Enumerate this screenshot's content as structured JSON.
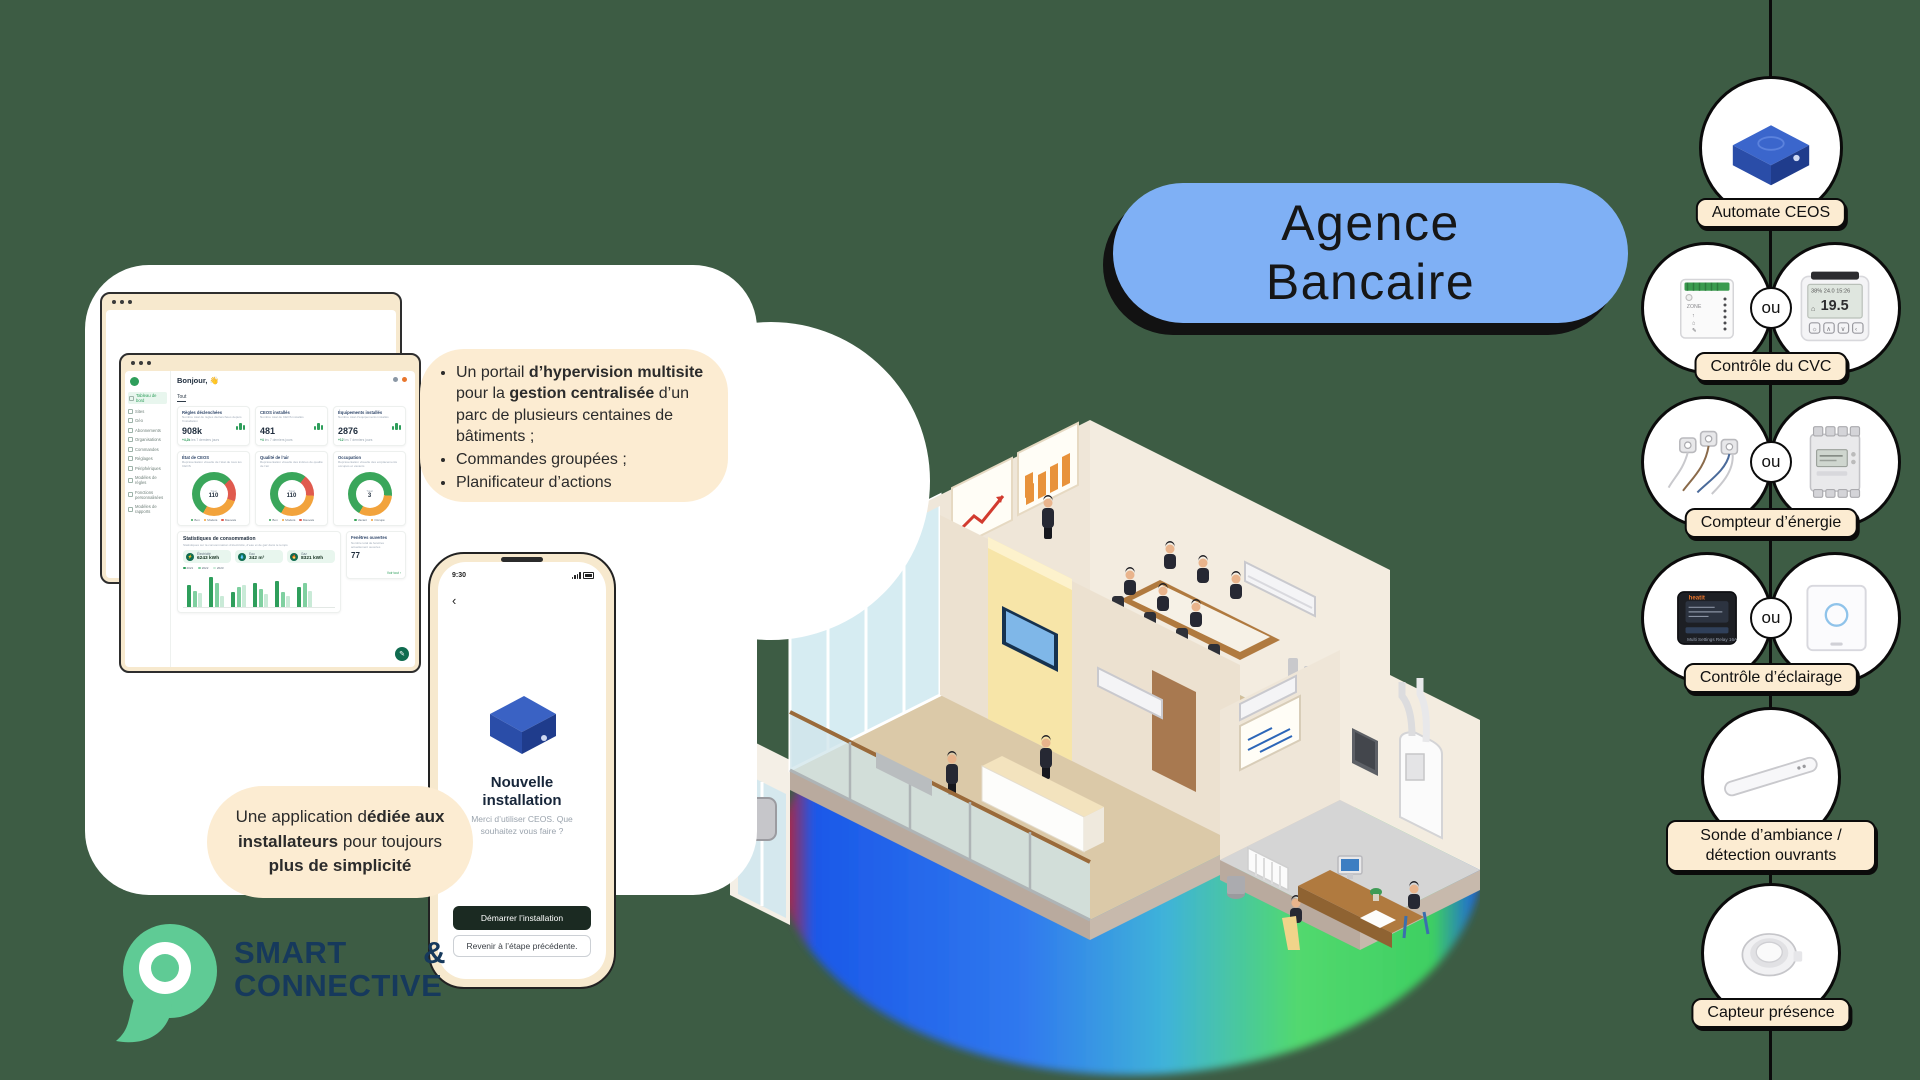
{
  "page": {
    "background": "#3d5c44"
  },
  "title_pill": {
    "line1": "Agence",
    "line2": "Bancaire",
    "bg": "#7fb0f5"
  },
  "callouts": {
    "portal": {
      "b1s1": "Un portail ",
      "b1s2": "d’hypervision multisite",
      "b1s3": " pour la ",
      "b1s4": "gestion centralisée",
      "b1s5": " d’un parc de plusieurs centaines de bâtiments ;",
      "b2": "Commandes groupées ;",
      "b3": "Planificateur d’actions"
    },
    "app": {
      "s1": "Une application d",
      "s2": "édiée aux installateurs",
      "s3": " pour toujours ",
      "s4": "plus de simplicité"
    }
  },
  "logo": {
    "word1": "SMART",
    "amp": "&",
    "word2": "CONNECTIVE"
  },
  "dashboard": {
    "greeting": "Bonjour,",
    "greeting_emoji": "👋",
    "tab": "Tout",
    "sidebar": [
      "Tableau de bord",
      "Sites",
      "Géo",
      "Abonnements",
      "Organisations",
      "Commandes",
      "Réglages",
      "Périphériques",
      "Modèles de règles",
      "Fonctions personnalisées",
      "Modèles de rapports"
    ],
    "stats": [
      {
        "title": "Règles déclenchées",
        "subtitle": "Nombre total de règles déclenchées depuis l’installation",
        "value": "908k",
        "delta_val": "+4,2k",
        "delta_txt": "les 7 derniers jours"
      },
      {
        "title": "CEOS installés",
        "subtitle": "Nombre total de CEOS installés",
        "value": "481",
        "delta_val": "+4",
        "delta_txt": "les 7 derniers jours"
      },
      {
        "title": "Équipements installés",
        "subtitle": "Nombre total d’équipements installés",
        "value": "2876",
        "delta_val": "+12",
        "delta_txt": "les 7 derniers jours"
      }
    ],
    "donuts": [
      {
        "title": "État de CEOS",
        "subtitle": "Représentation visuelle de l’état de tous les CEOS",
        "center_label": "Total",
        "center_value": "110",
        "segments": [
          [
            "#3aa65b",
            55
          ],
          [
            "#e05a4e",
            17
          ],
          [
            "#f2a33c",
            28
          ]
        ],
        "legend": [
          "Bon",
          "Modéré",
          "Mauvais"
        ],
        "legend_colors": [
          "#3aa65b",
          "#f2a33c",
          "#e05a4e"
        ]
      },
      {
        "title": "Qualité de l’air",
        "subtitle": "Représentation visuelle des indices de qualité de l’air",
        "center_label": "Total",
        "center_value": "110",
        "segments": [
          [
            "#3aa65b",
            52
          ],
          [
            "#e05a4e",
            16
          ],
          [
            "#f2a33c",
            32
          ]
        ],
        "legend": [
          "Bon",
          "Modéré",
          "Mauvais"
        ],
        "legend_colors": [
          "#3aa65b",
          "#f2a33c",
          "#e05a4e"
        ]
      },
      {
        "title": "Occupation",
        "subtitle": "Représentation visuelle des emplacements occupés et vacants",
        "center_label": "Total",
        "center_value": "3",
        "segments": [
          [
            "#3aa65b",
            68
          ],
          [
            "#f2a33c",
            32
          ]
        ],
        "legend": [
          "Vacant",
          "Occupé"
        ],
        "legend_colors": [
          "#3aa65b",
          "#f2a33c"
        ]
      }
    ],
    "consumption": {
      "title": "Statistiques de consommation",
      "subtitle": "Statistiques sur la consommation d’électricité, d’eau et de gaz dans le temps",
      "meters": [
        {
          "name": "Électricité",
          "value": "6243 kWh"
        },
        {
          "name": "Eau",
          "value": "342 m³"
        },
        {
          "name": "Gaz",
          "value": "8321 kWh"
        }
      ],
      "years": [
        "2021",
        "2022",
        "2023"
      ],
      "bars": {
        "groups": [
          [
            22,
            16,
            14
          ],
          [
            30,
            24,
            11
          ],
          [
            15,
            20,
            22
          ],
          [
            24,
            18,
            13
          ],
          [
            26,
            15,
            11
          ],
          [
            20,
            24,
            16
          ]
        ]
      }
    },
    "windows_card": {
      "title": "Fenêtres ouvertes",
      "subtitle": "Nombre total de fenêtres actuellement ouvertes",
      "value": "77",
      "link": "Voir tout ›"
    }
  },
  "phone": {
    "time": "9:30",
    "title_l1": "Nouvelle",
    "title_l2": "installation",
    "subtitle": "Merci d’utiliser CEOS. Que souhaitez vous faire ?",
    "primary_button": "Démarrer l’installation",
    "secondary_button": "Revenir à l’étape précédente."
  },
  "devices": [
    {
      "label": "Automate CEOS"
    },
    {
      "label": "Contrôle du CVC",
      "or": "ou",
      "thermostat_value": "19.5"
    },
    {
      "label": "Compteur d’énergie",
      "or": "ou"
    },
    {
      "label": "Contrôle d’éclairage",
      "or": "ou"
    },
    {
      "label": "Sonde d’ambiance / détection ouvrants"
    },
    {
      "label": "Capteur présence"
    }
  ],
  "colors": {
    "accent_green": "#2e9e5b",
    "brand_navy": "#16395c",
    "cream": "#fcecd2",
    "pill_blue": "#7fb0f5",
    "ceos_blue": "#2a4da8"
  }
}
